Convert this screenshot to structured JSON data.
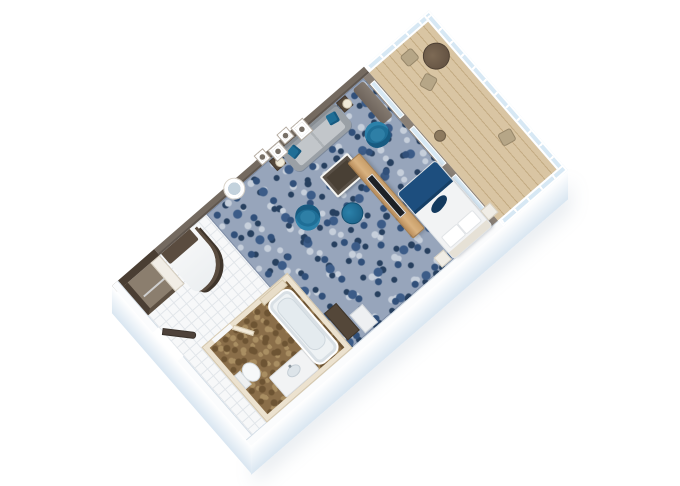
{
  "scene": {
    "type": "isometric-3d-floor-plan",
    "subject": "suite-with-balcony-floorplan-render",
    "background": "#ffffff",
    "rotation_deg": -41
  },
  "colors": {
    "carpet_base": "#97a5bb",
    "carpet_dark": "#31507a",
    "carpet_mid": "#3c5c88",
    "carpet_deep": "#27405f",
    "carpet_light": "#c6cfdb",
    "wall_accent": "#746a60",
    "wall_white": "#fbfcfd",
    "wall_face_shade": "#d9e6f1",
    "wall_dark_wood": "#4a3e33",
    "cream_wall": "#ece2cf",
    "bath_floor_base": "#8a6e49",
    "bath_floor_dark": "#6d5433",
    "bath_floor_light": "#a98e62",
    "deck_wood": "#d9c5a3",
    "deck_line": "#c3ab83",
    "glass": "#d7e8f4",
    "glass_frame": "#8a8076",
    "sofa_gray": "#9aa0a6",
    "sofa_cushion": "#c2c6ca",
    "teal": "#1f6e96",
    "teal_dark": "#175a80",
    "teal_light": "#2b81aa",
    "navy": "#1d4e7e",
    "navy_dark": "#143a5e",
    "wood_light": "#d9b280",
    "wood_edge": "#a87f4e",
    "dark_furniture": "#544739",
    "darker_furniture": "#3f362b",
    "table_top": "#494035",
    "tan_chair": "#b6a687",
    "balcony_table": "#5d4c3d",
    "tile": "#f7f8f9",
    "tile_line": "#e2e6ea",
    "linen_white": "#f2f3f4",
    "headboard_cream": "#e6e1d6"
  },
  "rooms": [
    {
      "name": "living-room",
      "floor": "blue-patterned-carpet",
      "furniture": [
        "gray-sofa",
        "teal-throw-pillows",
        "side-table-with-lamp-left",
        "side-table-with-lamp-right",
        "coffee-table",
        "teal-tub-armchair",
        "teal-tub-armchair",
        "teal-ottoman",
        "wood-tv-panel",
        "wall-art-frames",
        "round-mirror",
        "curtains"
      ]
    },
    {
      "name": "bedroom",
      "floor": "blue-patterned-carpet",
      "furniture": [
        "double-bed-white-linens",
        "navy-bed-runner",
        "navy-accent-pillow",
        "nightstand-left",
        "nightstand-right",
        "dark-dresser",
        "white-mini-cabinet"
      ]
    },
    {
      "name": "bathroom",
      "floor": "brown-mottled-tile",
      "furniture": [
        "bathtub",
        "toilet",
        "vanity-counter",
        "sink",
        "bathroom-door",
        "shelf"
      ]
    },
    {
      "name": "entry",
      "floor": "white-tile",
      "furniture": [
        "entrance-door",
        "open-closet-with-rod",
        "curved-white-counter"
      ]
    },
    {
      "name": "balcony",
      "floor": "wood-deck",
      "furniture": [
        "glass-railing",
        "round-dining-table",
        "deck-chair",
        "deck-chair",
        "deck-chair",
        "side-stool",
        "sliding-glass-doors"
      ]
    }
  ]
}
